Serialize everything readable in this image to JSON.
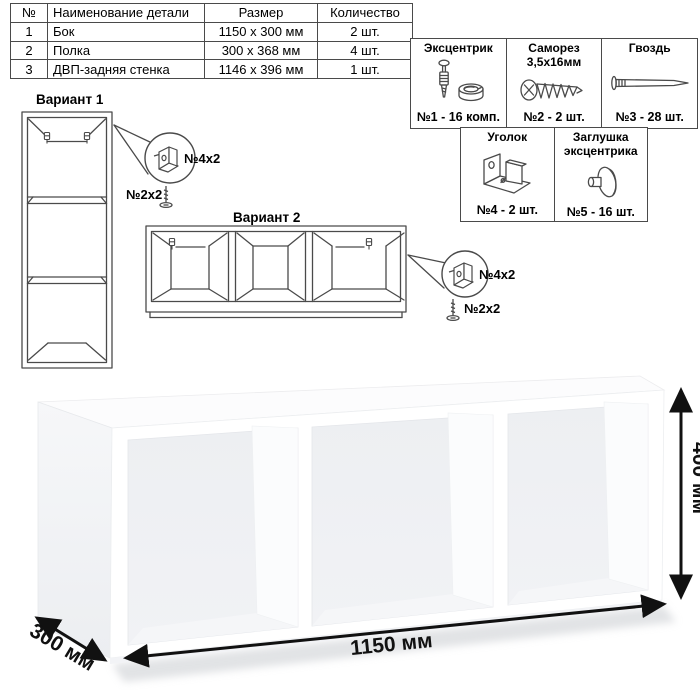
{
  "parts_table": {
    "headers": [
      "№",
      "Наименование детали",
      "Размер",
      "Количество"
    ],
    "rows": [
      {
        "num": "1",
        "name": "Бок",
        "size": "1150 x 300 мм",
        "qty": "2 шт."
      },
      {
        "num": "2",
        "name": "Полка",
        "size": "300 x 368 мм",
        "qty": "4 шт."
      },
      {
        "num": "3",
        "name": "ДВП-задняя стенка",
        "size": "1146 x 396 мм",
        "qty": "1 шт."
      }
    ]
  },
  "hardware": {
    "items": [
      {
        "name": "Эксцентрик",
        "qty": "№1 - 16 комп.",
        "icon": "eccentric-cam-icon"
      },
      {
        "name": "Саморез 3,5х16мм",
        "qty": "№2 - 2 шт.",
        "icon": "screw-icon"
      },
      {
        "name": "Гвоздь",
        "qty": "№3 - 28 шт.",
        "icon": "nail-icon"
      },
      {
        "name": "Уголок",
        "qty": "№4 - 2 шт.",
        "icon": "angle-bracket-icon"
      },
      {
        "name": "Заглушка эксцентрика",
        "qty": "№5 - 16 шт.",
        "icon": "cam-cap-icon"
      }
    ]
  },
  "variant1": {
    "title": "Вариант 1",
    "bracket_label": "№4x2",
    "screw_label": "№2x2"
  },
  "variant2": {
    "title": "Вариант 2",
    "bracket_label": "№4x2",
    "screw_label": "№2x2"
  },
  "dimensions": {
    "width": "1150 мм",
    "height": "400 мм",
    "depth": "300 мм"
  },
  "colors": {
    "line": "#4a4a4a",
    "dim_arrow": "#111111"
  }
}
